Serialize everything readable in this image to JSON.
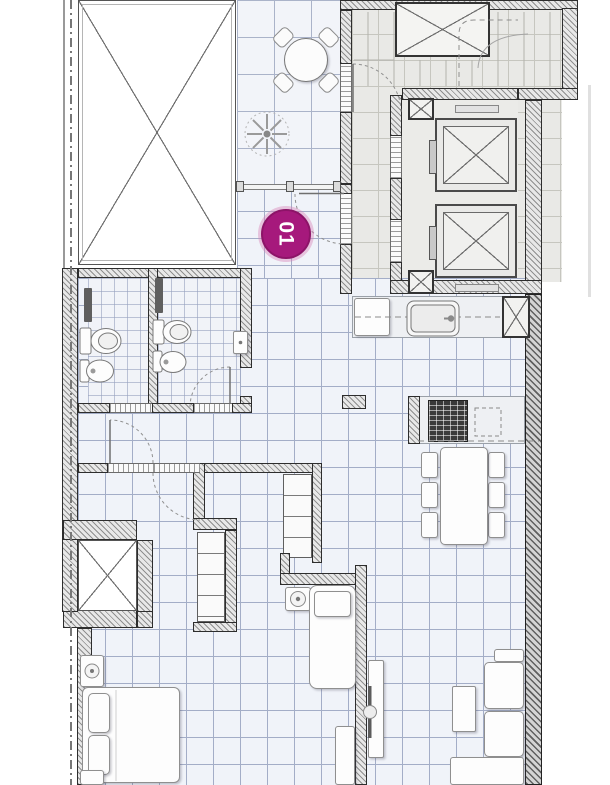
{
  "unit_badge": {
    "label": "01"
  },
  "colors": {
    "badge_fill": "#a6197c",
    "badge_ring": "#d77ab5",
    "badge_text": "#ffffff",
    "wall_outline": "#2d2d2d",
    "wall_hatch_fill": "#e8e8e8",
    "wall_hatch_stroke": "#8f8f8f",
    "tile_line": "#a3adc7",
    "tile_floor": "#f0f3f9",
    "terrace_tile_line": "#aab3c9",
    "lobby_floor": "#e9e9e6",
    "fixture_fill": "#fdfdfd",
    "fixture_outline": "#8f8f8f",
    "cooktop_fill": "#3a3a3a"
  },
  "fixture_icons": [
    "terrace-round-table-with-4-chairs",
    "potted-plant",
    "glass-partition",
    "entry-door-swing",
    "stair-flight",
    "stair-shaft",
    "elevator-car",
    "elevator-car",
    "duct-shaft",
    "duct-shaft",
    "duct-shaft",
    "light-well",
    "void-shaft",
    "toilet",
    "bidet",
    "shower-screen",
    "toilet",
    "bidet",
    "washbasin",
    "kitchen-counter",
    "refrigerator",
    "kitchen-sink",
    "kitchen-island",
    "cooktop",
    "dining-table-with-6-chairs",
    "wardrobe-closet",
    "wardrobe-closet",
    "double-bed",
    "pillow",
    "pillow",
    "nightstand-lamp",
    "single-bed",
    "nightstand-lamp",
    "desk",
    "tv-console",
    "sofa",
    "coffee-table",
    "property-line"
  ]
}
